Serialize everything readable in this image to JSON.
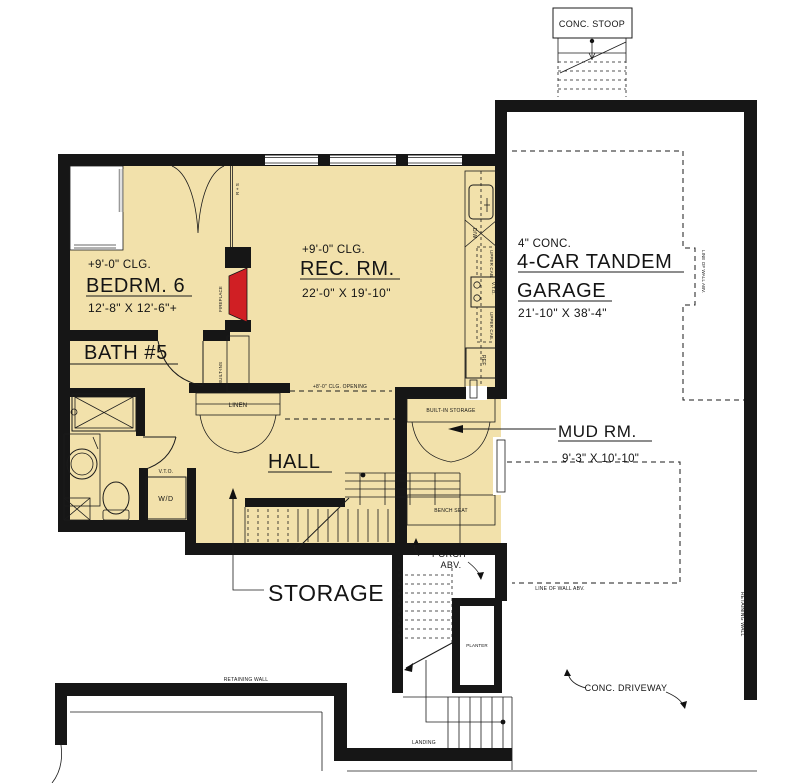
{
  "colors": {
    "floor_fill": "#f2e1ab",
    "wall": "#161616",
    "fireplace_red": "#d01f24",
    "paper": "#ffffff"
  },
  "rooms": {
    "bedroom6": {
      "ceiling": "+9'-0\" CLG.",
      "name": "BEDRM. 6",
      "dims": "12'-8\" X 12'-6\"+"
    },
    "rec_rm": {
      "ceiling": "+9'-0\" CLG.",
      "name": "REC. RM.",
      "dims": "22'-0\" X 19'-10\""
    },
    "bath5": {
      "name": "BATH #5"
    },
    "hall": {
      "name": "HALL"
    },
    "storage": {
      "name": "STORAGE"
    },
    "mud_rm": {
      "name": "MUD RM.",
      "dims": "9'-3\" X 10'-10\""
    },
    "garage": {
      "slab": "4\" CONC.",
      "name1": "4-CAR TANDEM",
      "name2": "GARAGE",
      "dims": "21'-10\" X 38'-4\""
    }
  },
  "labels": {
    "conc_stoop": "CONC. STOOP",
    "porch1": "PORCH",
    "porch2": "ABV.",
    "conc_driveway": "CONC. DRIVEWAY",
    "retaining_wall": "RETAINING WALL",
    "retaining_wall_right": "RETAINING WALL",
    "line_of_wall_abv_garage": "LINE OF WALL ABV.",
    "line_of_wall_abv_drive": "LINE OF WALL ABV.",
    "clg_opening": "+8'-0\" CLG. OPENING",
    "linen": "LINEN",
    "fireplace": "FIREPLACE",
    "built_ins": "BUILT-INS",
    "built_in_storage": "BUILT-IN STORAGE",
    "bench_seat": "BENCH SEAT",
    "rod_shelf": "R + S",
    "wd": "W/D",
    "vto_wd": "V.T.O.",
    "vto_range": "V.T.O.",
    "upper_cab1": "UPPER CAB.",
    "upper_cab2": "UPPER CAB.",
    "dw": "D/W",
    "ref": "REF",
    "planter": "PLANTER",
    "landing": "LANDING"
  }
}
